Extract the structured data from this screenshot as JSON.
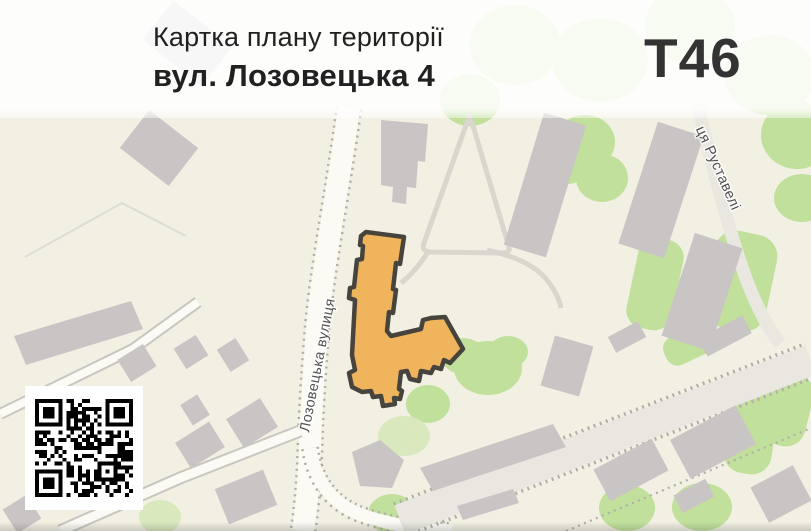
{
  "header": {
    "title": "Картка плану території",
    "subtitle": "вул. Лозовецька 4",
    "code": "Т46"
  },
  "map": {
    "street_labels": {
      "main": "Лозовецька вулиця",
      "secondary": "ця Руставелі"
    },
    "highlighted_building": "вул. Лозовецька 4"
  },
  "qr": {
    "modules": 25,
    "seed": 12
  },
  "colors": {
    "bg": "#f2f0e3",
    "building": "#c9c5c5",
    "green": "#c0e09b",
    "green_light": "#d9e8bd",
    "road": "#fbfaf5",
    "road_gray": "#e9e7e0",
    "casing": "#b2aea7",
    "highlight": "#f0b55c",
    "outline": "#47443e",
    "path": "#d9d6cd",
    "label": "#525252",
    "title": "#212121",
    "code": "#333333"
  }
}
